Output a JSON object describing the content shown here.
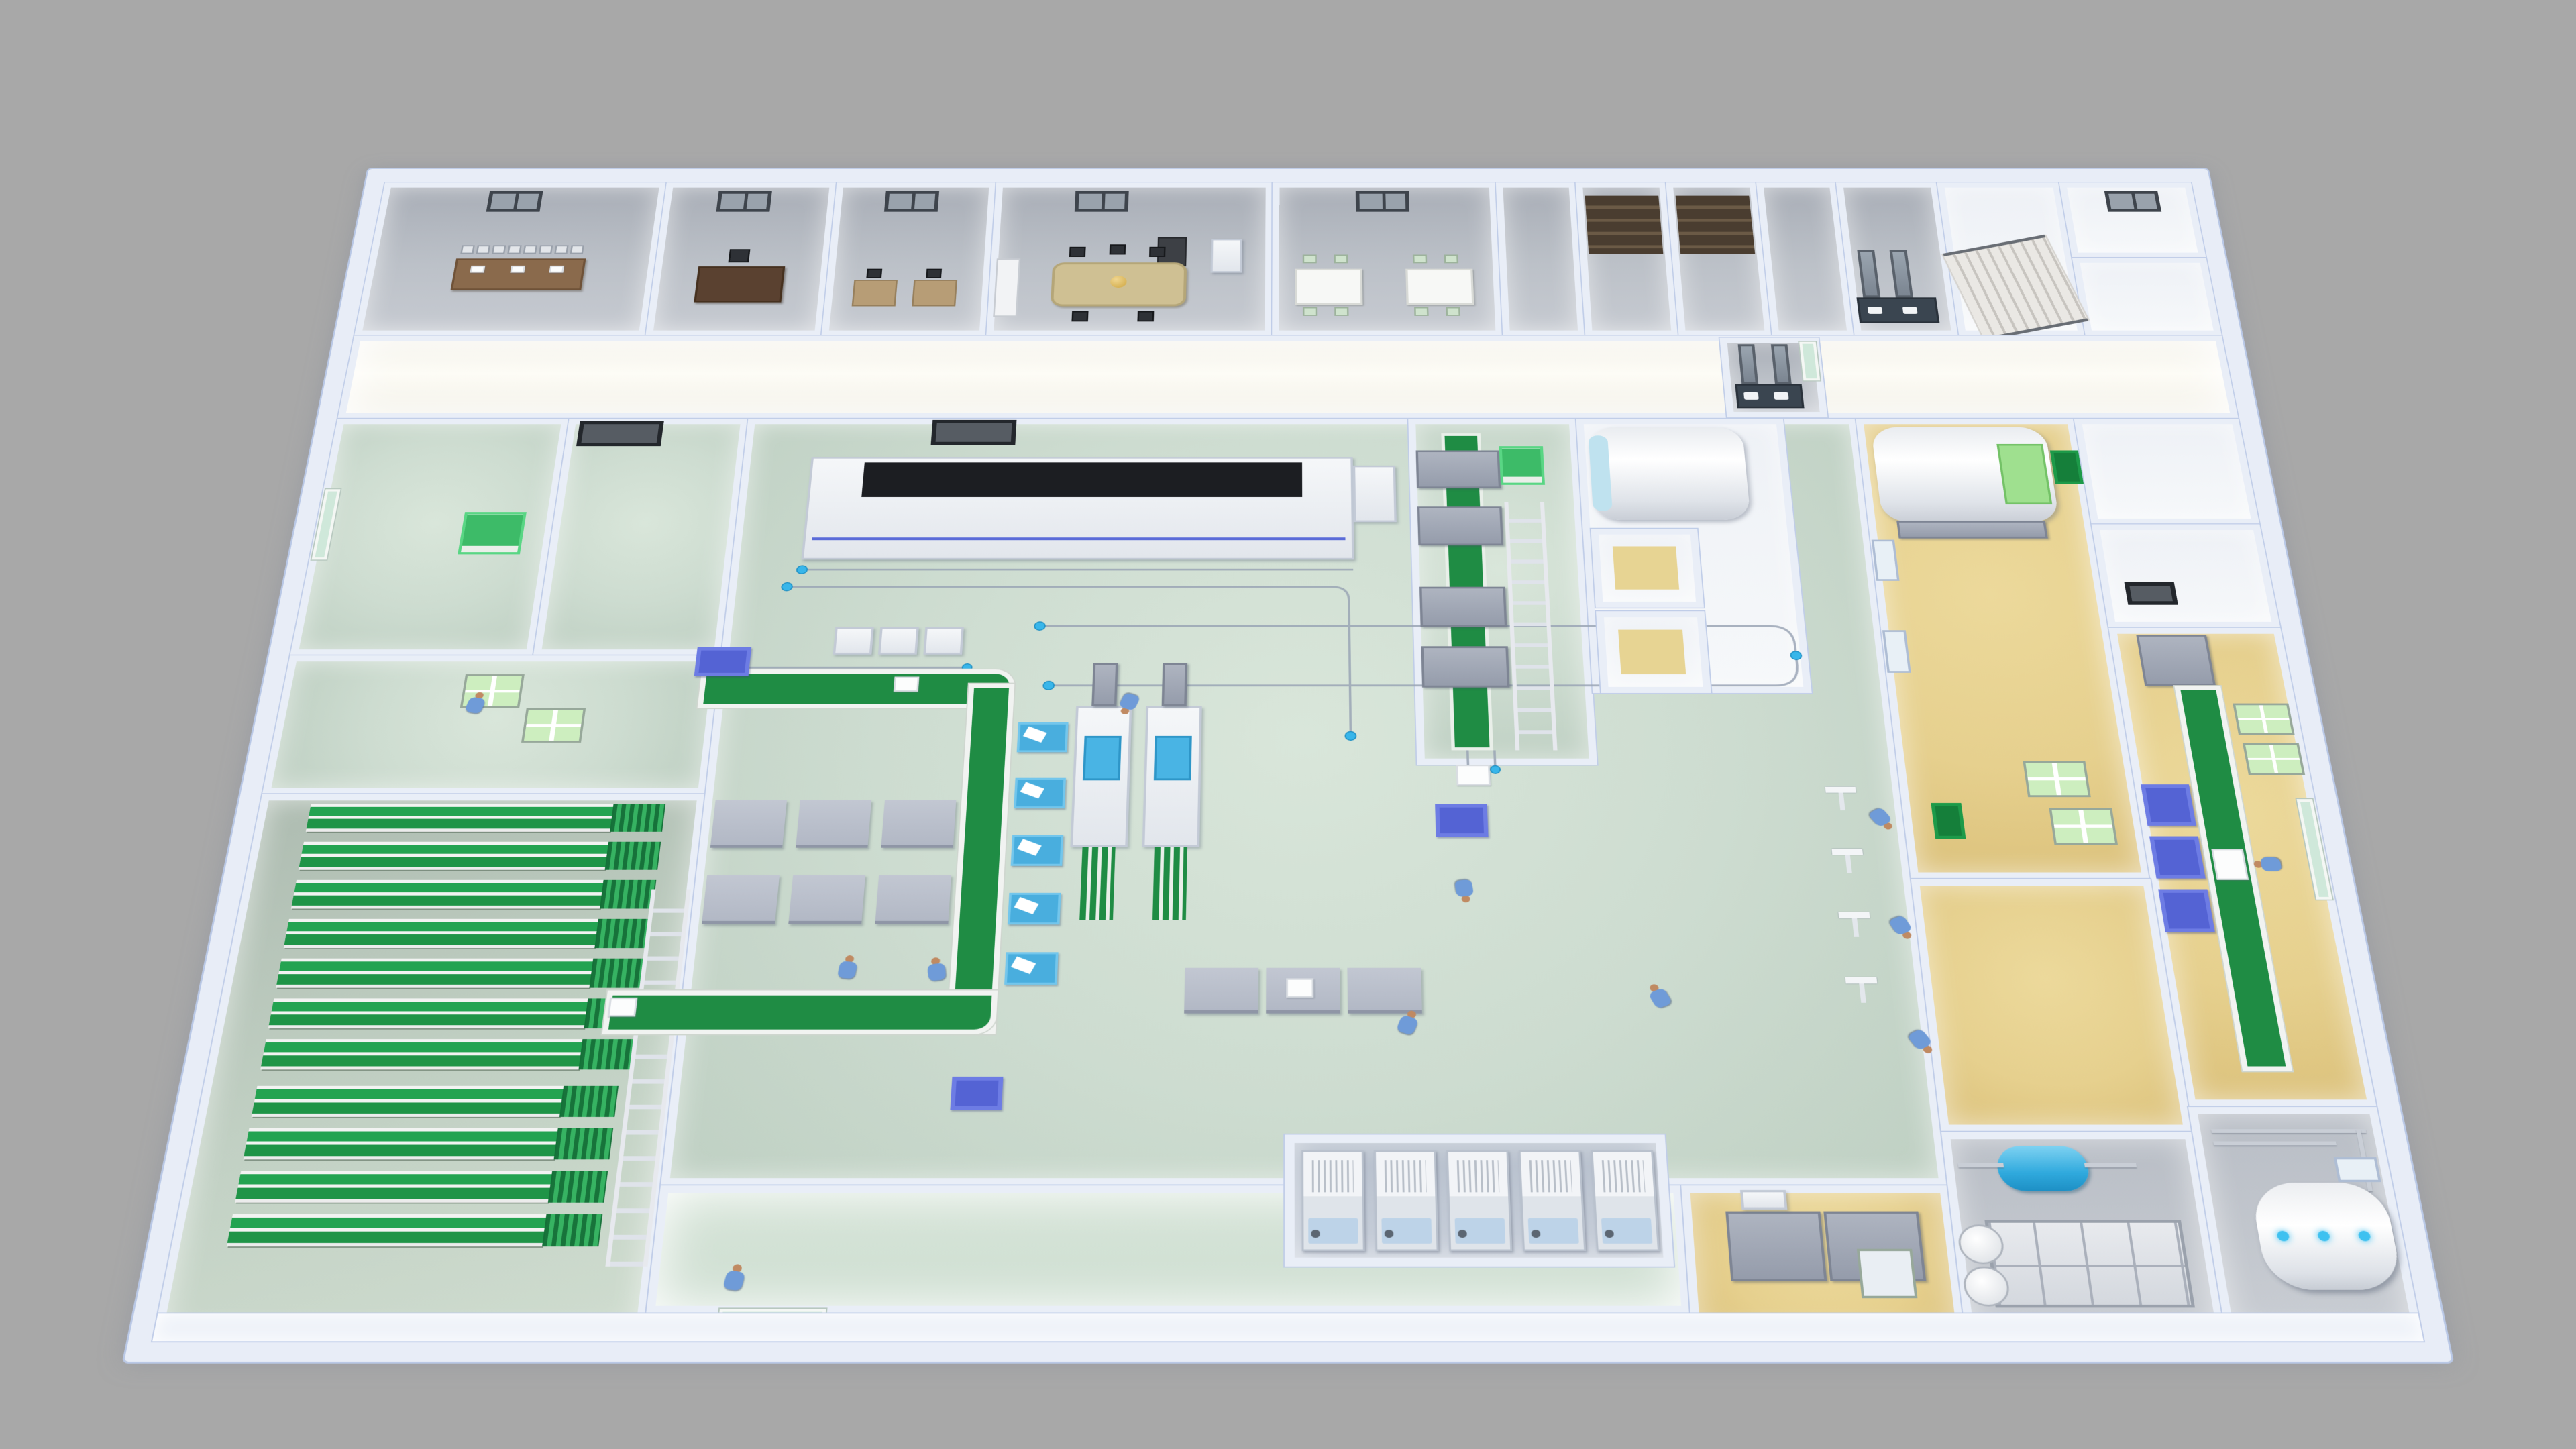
{
  "scene": {
    "title": "3D cutaway floor plan – pharmaceutical production facility",
    "view": "top-down dollhouse render",
    "background": "#a8a8a8"
  },
  "palette": {
    "wall": "#e9eef7",
    "wall_edge": "#b9c8e6",
    "corridor": "#fdfcf6",
    "floor_office": "#bcc1c8",
    "floor_mint": "#cddcd0",
    "floor_sage": "#c3d2c5",
    "floor_yellow": "#e6d08e",
    "floor_gray": "#c2c7cd",
    "rack_green": "#23a351",
    "belt_green": "#1f8c44",
    "crate_green": "#3dbb68",
    "tray_green": "#cdeebf",
    "bin_green": "#157f3a",
    "tote_blue": "#5463d4",
    "accent_cyan": "#38b6ea",
    "cable": "#9aa5b5",
    "worker_blue": "#6f9bd8",
    "skin": "#c08a62",
    "machine_white": "#f4f6f8",
    "machine_gray": "#9aa0ad",
    "panel_black": "#1c1e22",
    "glow_port": "#3ec1f0"
  },
  "zones": {
    "conference": {
      "label": "Conference room",
      "floor": "#bcc1c8"
    },
    "executive": {
      "label": "Executive office",
      "floor": "#bcc1c8"
    },
    "team_office": {
      "label": "Team office",
      "floor": "#bcc1c8"
    },
    "meeting": {
      "label": "Meeting room",
      "floor": "#bcc1c8"
    },
    "break_room": {
      "label": "Break room",
      "floor": "#bcc1c8"
    },
    "closet_a": {
      "label": "Storage closet A",
      "floor": "#bcc1c8"
    },
    "closet_b": {
      "label": "Storage closet B",
      "floor": "#bcc1c8"
    },
    "washroom": {
      "label": "Washroom",
      "floor": "#bcc1c8"
    },
    "stairwell": {
      "label": "Stairwell",
      "floor": "#d6d4d0"
    },
    "corridor_main": {
      "label": "Main corridor",
      "floor": "#fdfcf6"
    },
    "cleanroom_storage": {
      "label": "Cleanroom storage",
      "floor": "#cddcd0"
    },
    "airlock_room": {
      "label": "Airlock room",
      "floor": "#cddcd0"
    },
    "tray_staging": {
      "label": "Tray staging room",
      "floor": "#cddcd0"
    },
    "warehouse": {
      "label": "Warehouse – pallet racking",
      "floor": "#c3d2c5"
    },
    "production_hall": {
      "label": "Production hall",
      "floor": "#cddcd0"
    },
    "machine_line": {
      "label": "Process machine line",
      "floor": "#cddcd0"
    },
    "sterilizer_room": {
      "label": "Sterilizer drum room",
      "floor": "#eef1f6"
    },
    "autoclave_room": {
      "label": "Autoclave room",
      "floor": "#e6d08e"
    },
    "packing_room": {
      "label": "Packing room",
      "floor": "#e6d08e"
    },
    "service_rooms_right": {
      "label": "Service rooms",
      "floor": "#eef1f6"
    },
    "yellow_link": {
      "label": "Sterile link area",
      "floor": "#e6d08e"
    },
    "laundry": {
      "label": "Wash / laundry room",
      "floor": "#e6d08e"
    },
    "utility_water": {
      "label": "Utility – water tanks",
      "floor": "#c2c7cd"
    },
    "utility_boiler": {
      "label": "Utility – steam boiler",
      "floor": "#c2c7cd"
    },
    "equipment_bay": {
      "label": "Freeze-dryer bay",
      "floor": "#c8cfda"
    },
    "corridor_front": {
      "label": "Front corridor",
      "floor": "#d3e2d6"
    }
  },
  "equipment": {
    "tunnel_machine": {
      "label": "Depyrogenation tunnel",
      "color": "#f4f6f8",
      "panel": "#1c1e22"
    },
    "cartoners": {
      "label": "Filling / cartoning machines",
      "count": 2,
      "accent": "#38b6ea"
    },
    "fill_stations": {
      "label": "Blue fill stations",
      "count": 5,
      "color": "#49aede"
    },
    "sterilizer_drum": {
      "label": "Sterilizer drum",
      "color": "#ffffff"
    },
    "autoclave": {
      "label": "Autoclave with loading tray",
      "tray": "#9fe08f"
    },
    "steam_boiler": {
      "label": "Steam boiler",
      "ports": 3,
      "port_color": "#3ec1f0"
    },
    "cyan_tank": {
      "label": "Pressure tank",
      "color": "#2fa9dd"
    },
    "modular_tank": {
      "label": "Sectional water tank",
      "color": "#d4d8de"
    },
    "freeze_dryers": {
      "label": "Freeze dryers",
      "count": 5
    },
    "green_belts": {
      "label": "Belt conveyors",
      "segments": 4,
      "color": "#1f8c44"
    },
    "roller_ladders": {
      "label": "Roller conveyors",
      "count": 3
    },
    "overhead_rail": {
      "label": "Overhead cable rail",
      "color": "#9aa5b5"
    },
    "pallet_racks": {
      "label": "Green pallet racks",
      "color": "#23a351"
    },
    "tray_carts": {
      "label": "Wire tray carts",
      "count": 7,
      "tray_color": "#cdeebf"
    },
    "totes": {
      "label": "Blue totes",
      "count": 9,
      "color": "#5463d4"
    },
    "laundry_washer": {
      "label": "Washer unit",
      "color": "#c6cbd3"
    }
  },
  "counts": {
    "racks_upper": 7,
    "racks_lower": 4,
    "freeze_dryers": 5,
    "fill_stations": 5,
    "assembly_tables": 6,
    "inspection_tables": 3,
    "conference_chairs": 8,
    "break_chairs": 8,
    "strip_machines": 4,
    "packing_totes": 3,
    "drop_stands": 4,
    "workers": 12
  },
  "people": {
    "label": "Operators in blue scrubs",
    "count": 12,
    "uniform": "#6f9bd8"
  }
}
